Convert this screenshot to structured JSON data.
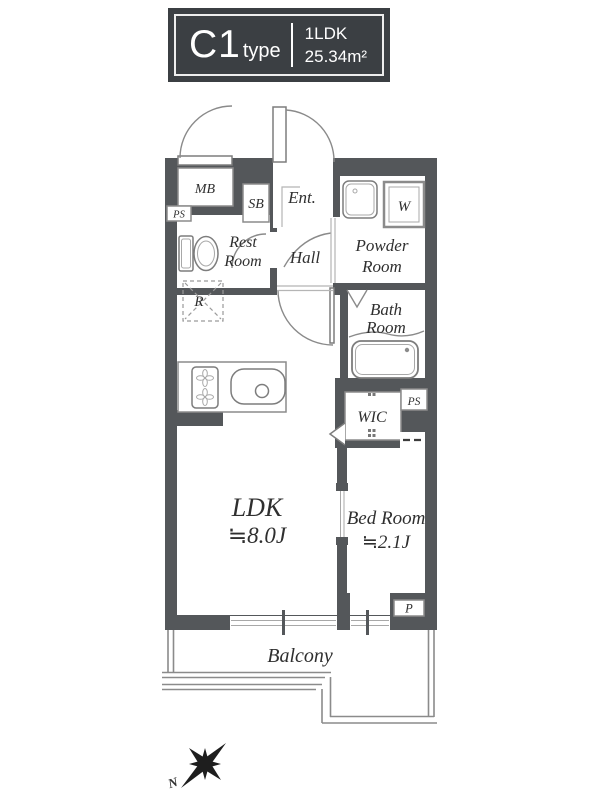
{
  "title_block": {
    "type_name": "C1",
    "type_suffix": "type",
    "layout": "1LDK",
    "area": "25.34m²"
  },
  "rooms": {
    "mb": "MB",
    "sb": "SB",
    "ent": "Ent.",
    "rest_line1": "Rest",
    "rest_line2": "Room",
    "hall": "Hall",
    "powder_line1": "Powder",
    "powder_line2": "Room",
    "washer": "W",
    "bath_line1": "Bath",
    "bath_line2": "Room",
    "fridge": "R",
    "wic": "WIC",
    "ps_left": "PS",
    "ps_right": "PS",
    "pipe": "P",
    "ldk_name": "LDK",
    "ldk_size": "≒8.0J",
    "bedroom_name": "Bed Room",
    "bedroom_size": "≒2.1J",
    "balcony": "Balcony",
    "north": "N"
  },
  "colors": {
    "wall": "#54575a",
    "title_bg": "#3b3f43",
    "line": "#8b8b8b",
    "label_text": "#2f2f2f",
    "title_text": "#ffffff"
  }
}
